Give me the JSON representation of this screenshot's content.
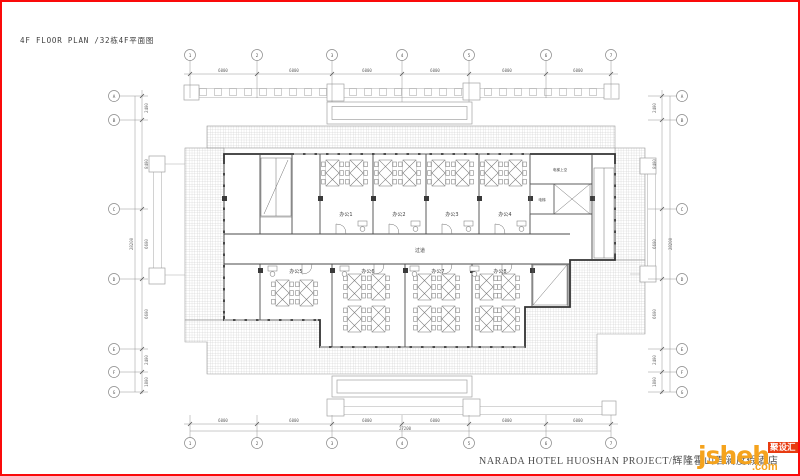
{
  "frame": {
    "border_color": "#fa0a0a",
    "background": "#ffffff"
  },
  "title_block": {
    "title": "4F FLOOR PLAN /32栋4F平面图"
  },
  "footer": {
    "project_title": "NARADA HOTEL HUOSHAN PROJECT/辉隆霍山君澜度假酒店"
  },
  "watermark": {
    "brand": "jsheh",
    "tld": ".com",
    "badge": "聚设汇",
    "brand_color": "#f5a31d",
    "badge_bg": "#e83a0f",
    "badge_text_color": "#ffffff"
  },
  "plan": {
    "rooms": {
      "office1": "办公1",
      "office2": "办公2",
      "office3": "办公3",
      "office4": "办公4",
      "office5": "办公5",
      "office6": "办公6",
      "office7": "办公7",
      "office8": "办公8",
      "corridor": "过道",
      "elevator_upper": "电梯上空",
      "elevator": "电梯"
    },
    "grid": {
      "cols": [
        "1",
        "2",
        "3",
        "4",
        "5",
        "6",
        "7"
      ],
      "rows": [
        "A",
        "B",
        "C",
        "D",
        "E",
        "F",
        "G"
      ]
    },
    "dims": {
      "top": [
        "6000",
        "6000",
        "6000",
        "6000",
        "6000",
        "6000"
      ],
      "bottom": [
        "6000",
        "6000",
        "6000",
        "6000",
        "6000",
        "6000"
      ],
      "bottom_total": "27200",
      "side": [
        "2400",
        "8400",
        "6600",
        "6600",
        "2400",
        "1800"
      ],
      "side_total": "28200"
    }
  }
}
